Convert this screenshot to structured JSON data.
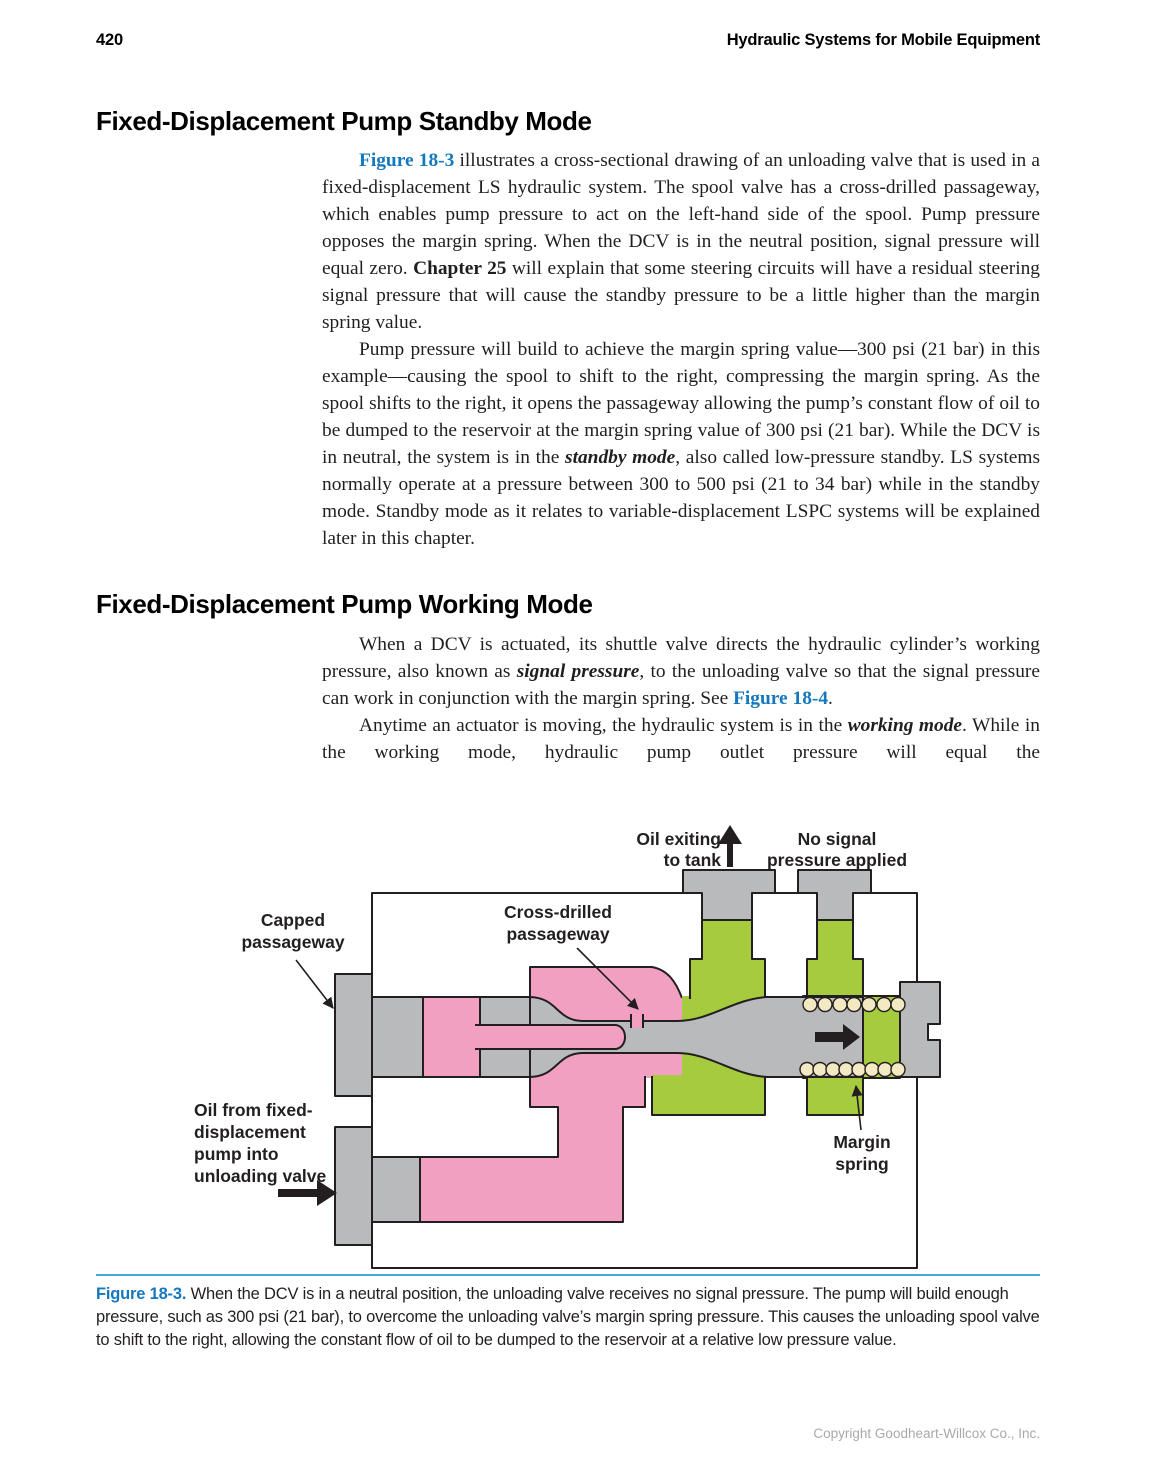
{
  "page_header": {
    "page_number": "420",
    "running_title": "Hydraulic Systems for Mobile Equipment"
  },
  "sections": [
    {
      "heading": "Fixed-Displacement Pump Standby Mode",
      "paragraphs": {
        "p1": [
          {
            "t": "Figure 18-3",
            "s": "ref"
          },
          {
            "t": " illustrates a cross-sectional drawing of an unloading valve that is used in a fixed-displacement LS hydraulic system. The spool valve has a cross-drilled passageway, which enables pump pressure to act on the left-hand side of the spool. Pump pressure opposes the margin spring. When the DCV is in the neutral position, signal pressure will equal zero. ",
            "s": ""
          },
          {
            "t": "Chapter 25",
            "s": "b"
          },
          {
            "t": " will explain that some steering circuits will have a residual steering signal pressure that will cause the standby pressure to be a little higher than the margin spring value.",
            "s": ""
          }
        ],
        "p2": [
          {
            "t": "Pump pressure will build to achieve the margin spring value—300 psi (21 bar) in this example—causing the spool to shift to the right, compressing the margin spring. As the spool shifts to the right, it opens the passageway allowing the pump’s constant flow of oil to be dumped to the reservoir at the margin spring value of 300 psi (21 bar). While the DCV is in neutral, the system is in the ",
            "s": ""
          },
          {
            "t": "standby mode",
            "s": "bi"
          },
          {
            "t": ", also called low-pressure standby. LS systems normally operate at a pressure between 300 to 500 psi (21 to 34 bar) while in the standby mode. Standby mode as it relates to variable-displacement LSPC systems will be explained later in this chapter.",
            "s": ""
          }
        ]
      }
    },
    {
      "heading": "Fixed-Displacement Pump Working Mode",
      "paragraphs": {
        "p3": [
          {
            "t": "When a DCV is actuated, its shuttle valve directs the hydraulic cylinder’s working pressure, also known as ",
            "s": ""
          },
          {
            "t": "signal pressure",
            "s": "bi"
          },
          {
            "t": ", to the unloading valve so that the signal pressure can work in conjunction with the margin spring. See ",
            "s": ""
          },
          {
            "t": "Figure 18-4",
            "s": "ref"
          },
          {
            "t": ".",
            "s": ""
          }
        ],
        "p4": [
          {
            "t": "Anytime an actuator is moving, the hydraulic system is in the ",
            "s": ""
          },
          {
            "t": "working mode",
            "s": "bi"
          },
          {
            "t": ". While in the working mode, hydraulic pump outlet pressure will equal the",
            "s": ""
          }
        ]
      }
    }
  ],
  "figure": {
    "labels": {
      "oil_exiting_1": "Oil exiting",
      "oil_exiting_2": "to tank",
      "no_signal_1": "No signal",
      "no_signal_2": "pressure applied",
      "capped_1": "Capped",
      "capped_2": "passageway",
      "cross_1": "Cross-drilled",
      "cross_2": "passageway",
      "pump_in_1": "Oil from fixed-",
      "pump_in_2": "displacement",
      "pump_in_3": "pump into",
      "pump_in_4": "unloading valve",
      "margin_1": "Margin",
      "margin_2": "spring"
    },
    "caption": [
      {
        "t": "Figure 18-3. ",
        "s": "ref"
      },
      {
        "t": "When the DCV is in a neutral position, the unloading valve receives no signal pressure. The pump will build enough pressure, such as 300 psi (21 bar), to overcome the unloading valve’s margin spring pressure. This causes the unloading spool valve to shift to the right, allowing the constant flow of oil to be dumped to the reservoir at a relative low pressure value.",
        "s": ""
      }
    ],
    "colors": {
      "accent_blue": "#1478BE",
      "rule_blue": "#3FA9E2",
      "ink": "#231F20",
      "pink": "#F2A0C2",
      "green": "#A6CB3E",
      "gray": "#B9BABC",
      "cream": "#F3EAC3",
      "copyright_gray": "#A7A9AC"
    }
  },
  "footer": {
    "copyright": "Copyright Goodheart-Willcox Co., Inc."
  }
}
